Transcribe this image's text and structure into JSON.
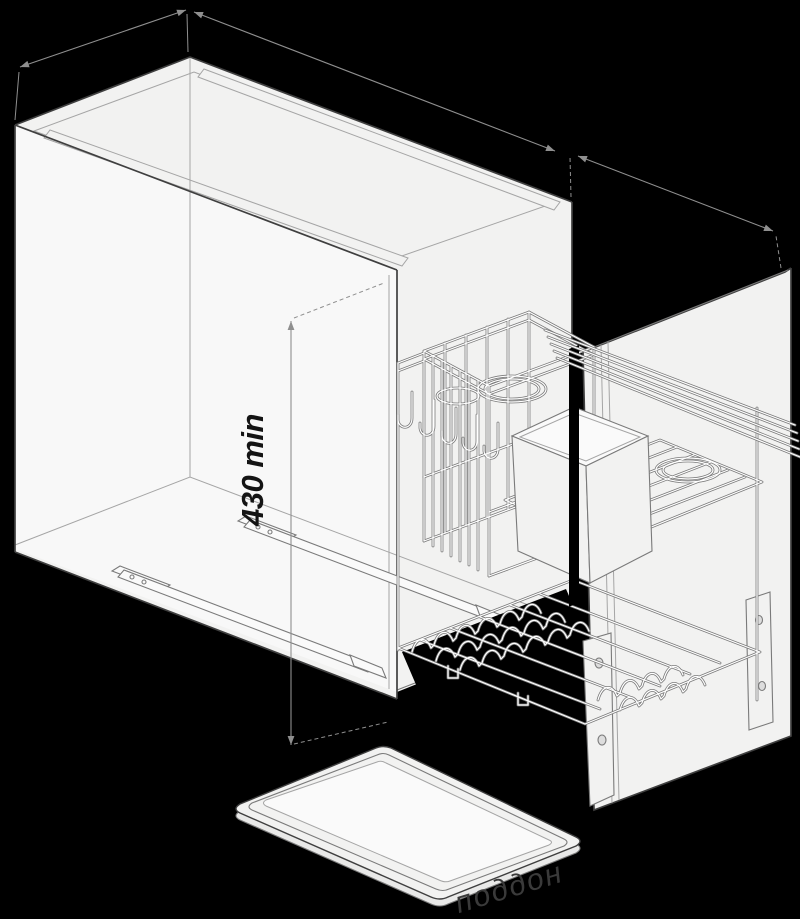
{
  "labels": {
    "height_dimension": "430 min",
    "watermark": "поддон"
  },
  "colors": {
    "background": "#000000",
    "panel_fill": "#f2f2f1",
    "panel_fill_bright": "#fafafa",
    "interior_fill": "#e9e9e8",
    "line_strong": "#3f3f3f",
    "line_medium": "#7a7a7a",
    "line_light": "#a5a5a5",
    "wire_core": "#ffffff",
    "dimension_line": "#8f8f8f",
    "dimension_text": "#141414",
    "watermark_text": "#3a3a3a"
  }
}
